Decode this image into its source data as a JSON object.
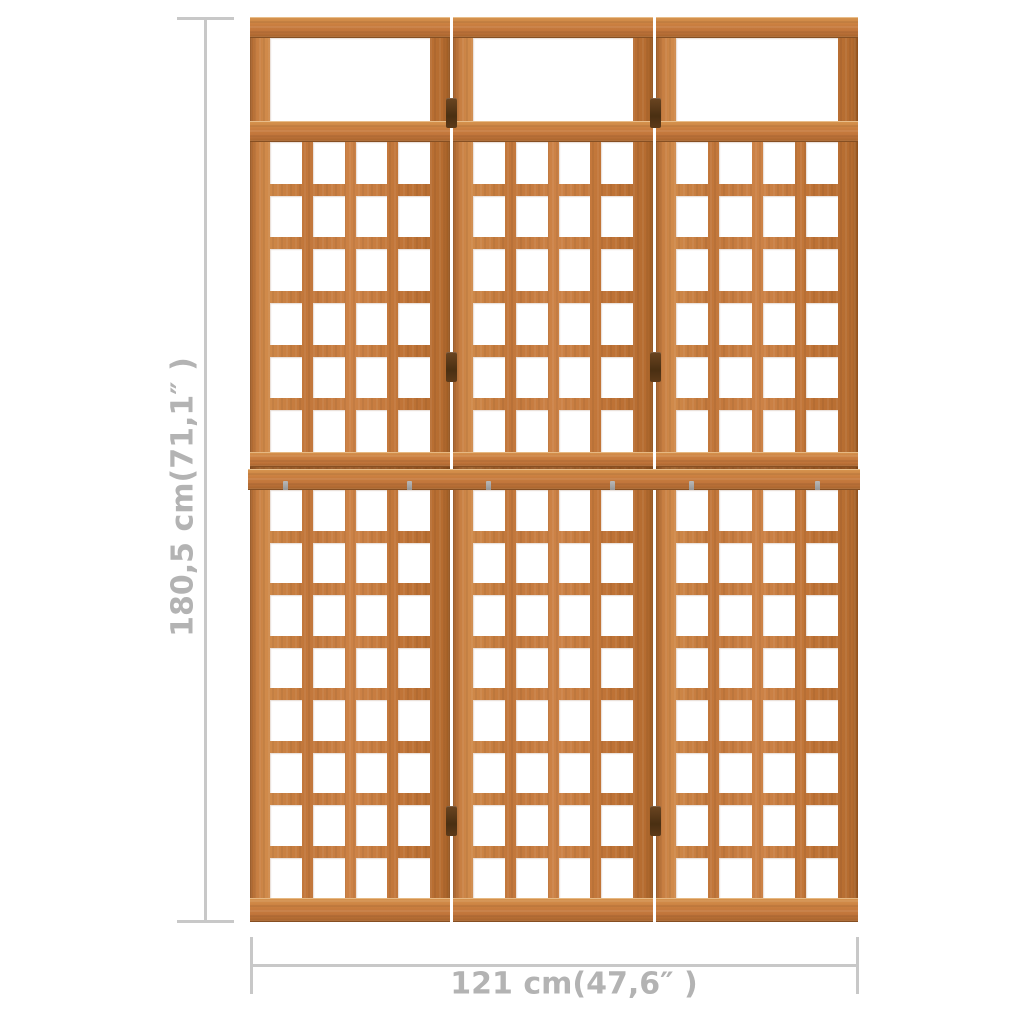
{
  "image": {
    "background": "#ffffff",
    "subject": "3-panel wooden trellis room divider with dimension annotations"
  },
  "dimensions": {
    "height_label": "180,5 cm(71,1″ )",
    "width_label": "121 cm(47,6″ )",
    "line_color": "#c8c8c8",
    "text_color": "#b3b3b3"
  },
  "product": {
    "wood_color": "#c1763a",
    "wood_highlight": "#d08a4a",
    "wood_shadow": "#96561f",
    "hinge_color": "#4a2f12",
    "structure": {
      "panels": 3,
      "top_opening_per_panel": 1,
      "upper_lattice": {
        "rows": 6,
        "cols": 4
      },
      "lower_lattice": {
        "rows": 8,
        "cols": 4
      },
      "hinge_joints": 2,
      "hinges_per_joint": 3
    }
  }
}
